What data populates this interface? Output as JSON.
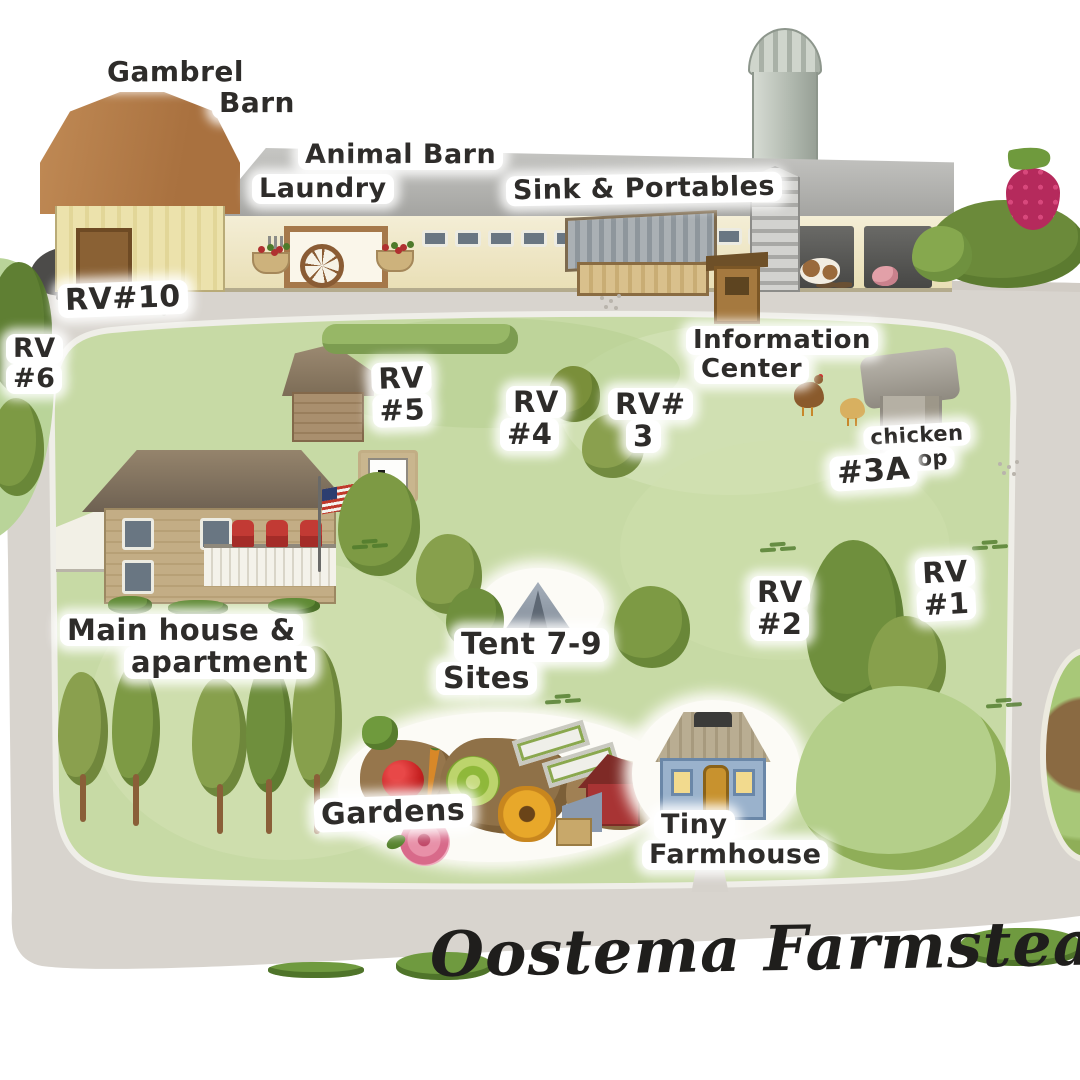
{
  "title": "Oostema Farmstead",
  "palette": {
    "road": "#d8d4ce",
    "field_green": "#c7daa5",
    "tree_green": "#7d9a44",
    "barn_wall_yellow": "#ece2ac",
    "gambrel_roof_brown": "#b5814e",
    "barn_roof_gray": "#aeaeab",
    "house_tan": "#c3ad85",
    "tiny_house_blue": "#9ab2cc",
    "chair_red": "#c23a34",
    "raspberry_red": "#b52a5c",
    "ink": "#2e2c2a"
  },
  "labels": {
    "gambrel_barn": {
      "lines": [
        "Gambrel",
        "Barn"
      ]
    },
    "animal_barn": {
      "lines": [
        "Animal Barn"
      ]
    },
    "laundry": {
      "lines": [
        "Laundry"
      ]
    },
    "sink_portables": {
      "lines": [
        "Sink & Portables"
      ]
    },
    "rv10": {
      "lines": [
        "RV#10"
      ]
    },
    "rv6": {
      "lines": [
        "RV",
        "#6"
      ]
    },
    "rv5": {
      "lines": [
        "RV",
        "#5"
      ]
    },
    "rv4": {
      "lines": [
        "RV",
        "#4"
      ]
    },
    "rv3": {
      "lines": [
        "RV#",
        "3"
      ]
    },
    "info_center": {
      "lines": [
        "Information",
        "Center"
      ]
    },
    "chicken_coop": {
      "lines": [
        "chicken",
        "coop"
      ]
    },
    "site_3a": {
      "lines": [
        "#3A"
      ]
    },
    "rv2": {
      "lines": [
        "RV",
        "#2"
      ]
    },
    "rv1": {
      "lines": [
        "RV",
        "#1"
      ]
    },
    "main_house": {
      "lines": [
        "Main house &",
        "apartment"
      ]
    },
    "tent_sites": {
      "lines": [
        "Tent 7-9",
        "Sites"
      ]
    },
    "gardens": {
      "lines": [
        "Gardens"
      ]
    },
    "tiny_farmhouse": {
      "lines": [
        "Tiny",
        "Farmhouse"
      ]
    }
  }
}
